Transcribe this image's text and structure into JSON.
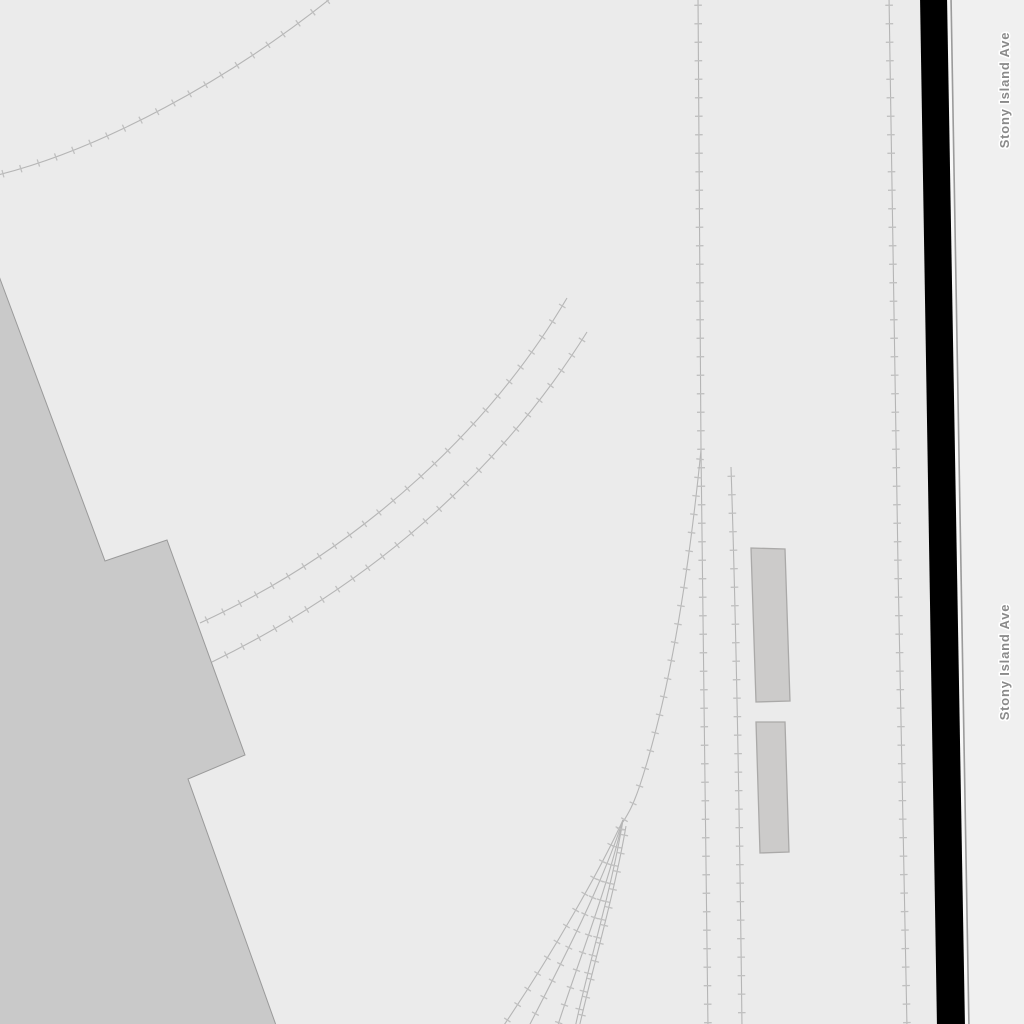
{
  "map": {
    "background_color": "#ebebeb",
    "road_strip_color": "#f0f0f0",
    "palette": {
      "parcel_fill": "#c9c9c9",
      "parcel_stroke": "#9a9a9a",
      "building_fill": "#cccbca",
      "building_stroke": "#aaa9a8",
      "track_stroke": "#b5b5b5",
      "tick_stroke": "#c0c0c0",
      "road_band_fill": "#000000",
      "road_white_edge": "#f8f8f8",
      "road_gray_edge": "#9b9b9b",
      "label_color": "#8a8a8a",
      "label_halo": "#ffffff"
    },
    "road_labels": [
      {
        "text": "Stony Island Ave",
        "x": 1009,
        "y": 90,
        "rotation": -90
      },
      {
        "text": "Stony Island Ave",
        "x": 1009,
        "y": 662,
        "rotation": -90
      }
    ],
    "areas": [
      {
        "name": "industrial-area",
        "d": "M -4,268 L 105,561 L 167,540 L 245,755 L 188,779 L 277,1028 L -4,1028 Z"
      }
    ],
    "buildings": [
      {
        "name": "building",
        "d": "M 751,548 L 785,549 L 790,701 L 756,702 Z"
      },
      {
        "name": "building",
        "d": "M 756,722 L 785,722 L 789,852 L 760,853 Z"
      }
    ],
    "tracks": [
      {
        "name": "railway-curve-northwest",
        "d": "M -6,176 C 100,150 230,80 336,-6"
      },
      {
        "name": "railway-curve-middle-upper",
        "d": "M 567,298 C 495,420 370,545 200,623"
      },
      {
        "name": "railway-curve-middle-lower",
        "d": "M 587,332 C 510,455 390,575 212,662"
      },
      {
        "name": "railway-main-vertical",
        "d": "M 698,-4 L 701,450 C 703,640 706,840 708,1028"
      },
      {
        "name": "railway-branch-southwest",
        "d": "M 701,450 C 688,580 668,700 640,785 C 633,806 628,814 623,822"
      },
      {
        "name": "railway-siding-1",
        "d": "M 623,820 C 600,870 555,950 502,1028"
      },
      {
        "name": "railway-siding-2",
        "d": "M 623,820 C 602,885 563,960 528,1028"
      },
      {
        "name": "railway-siding-3",
        "d": "M 623,820 C 607,890 578,962 557,1028"
      },
      {
        "name": "railway-siding-4",
        "d": "M 623,820 C 611,892 589,962 575,1028"
      },
      {
        "name": "railway-siding-5",
        "d": "M 626,826 C 614,896 593,966 579,1028"
      },
      {
        "name": "railway-stub-vertical",
        "d": "M 731,467 C 737,650 740,850 742,1028"
      },
      {
        "name": "railway-east-vertical",
        "d": "M 889,-4 C 893,300 900,700 907,1028"
      }
    ],
    "road": {
      "strip_d": "M 951,-4 L 1028,-4 L 1028,1028 L 969,1028 Z",
      "white_edge_d": "M 948.5,-4 L 966.5,1028",
      "gray_edge_d": "M 951,-4 L 969,1028",
      "band_d": "M 920,-4 L 947,-4 L 965,1028 L 937,1028 Z"
    },
    "tick_settings": {
      "spacing": 18.5,
      "half_length": 3.8,
      "width": 1.3
    }
  }
}
